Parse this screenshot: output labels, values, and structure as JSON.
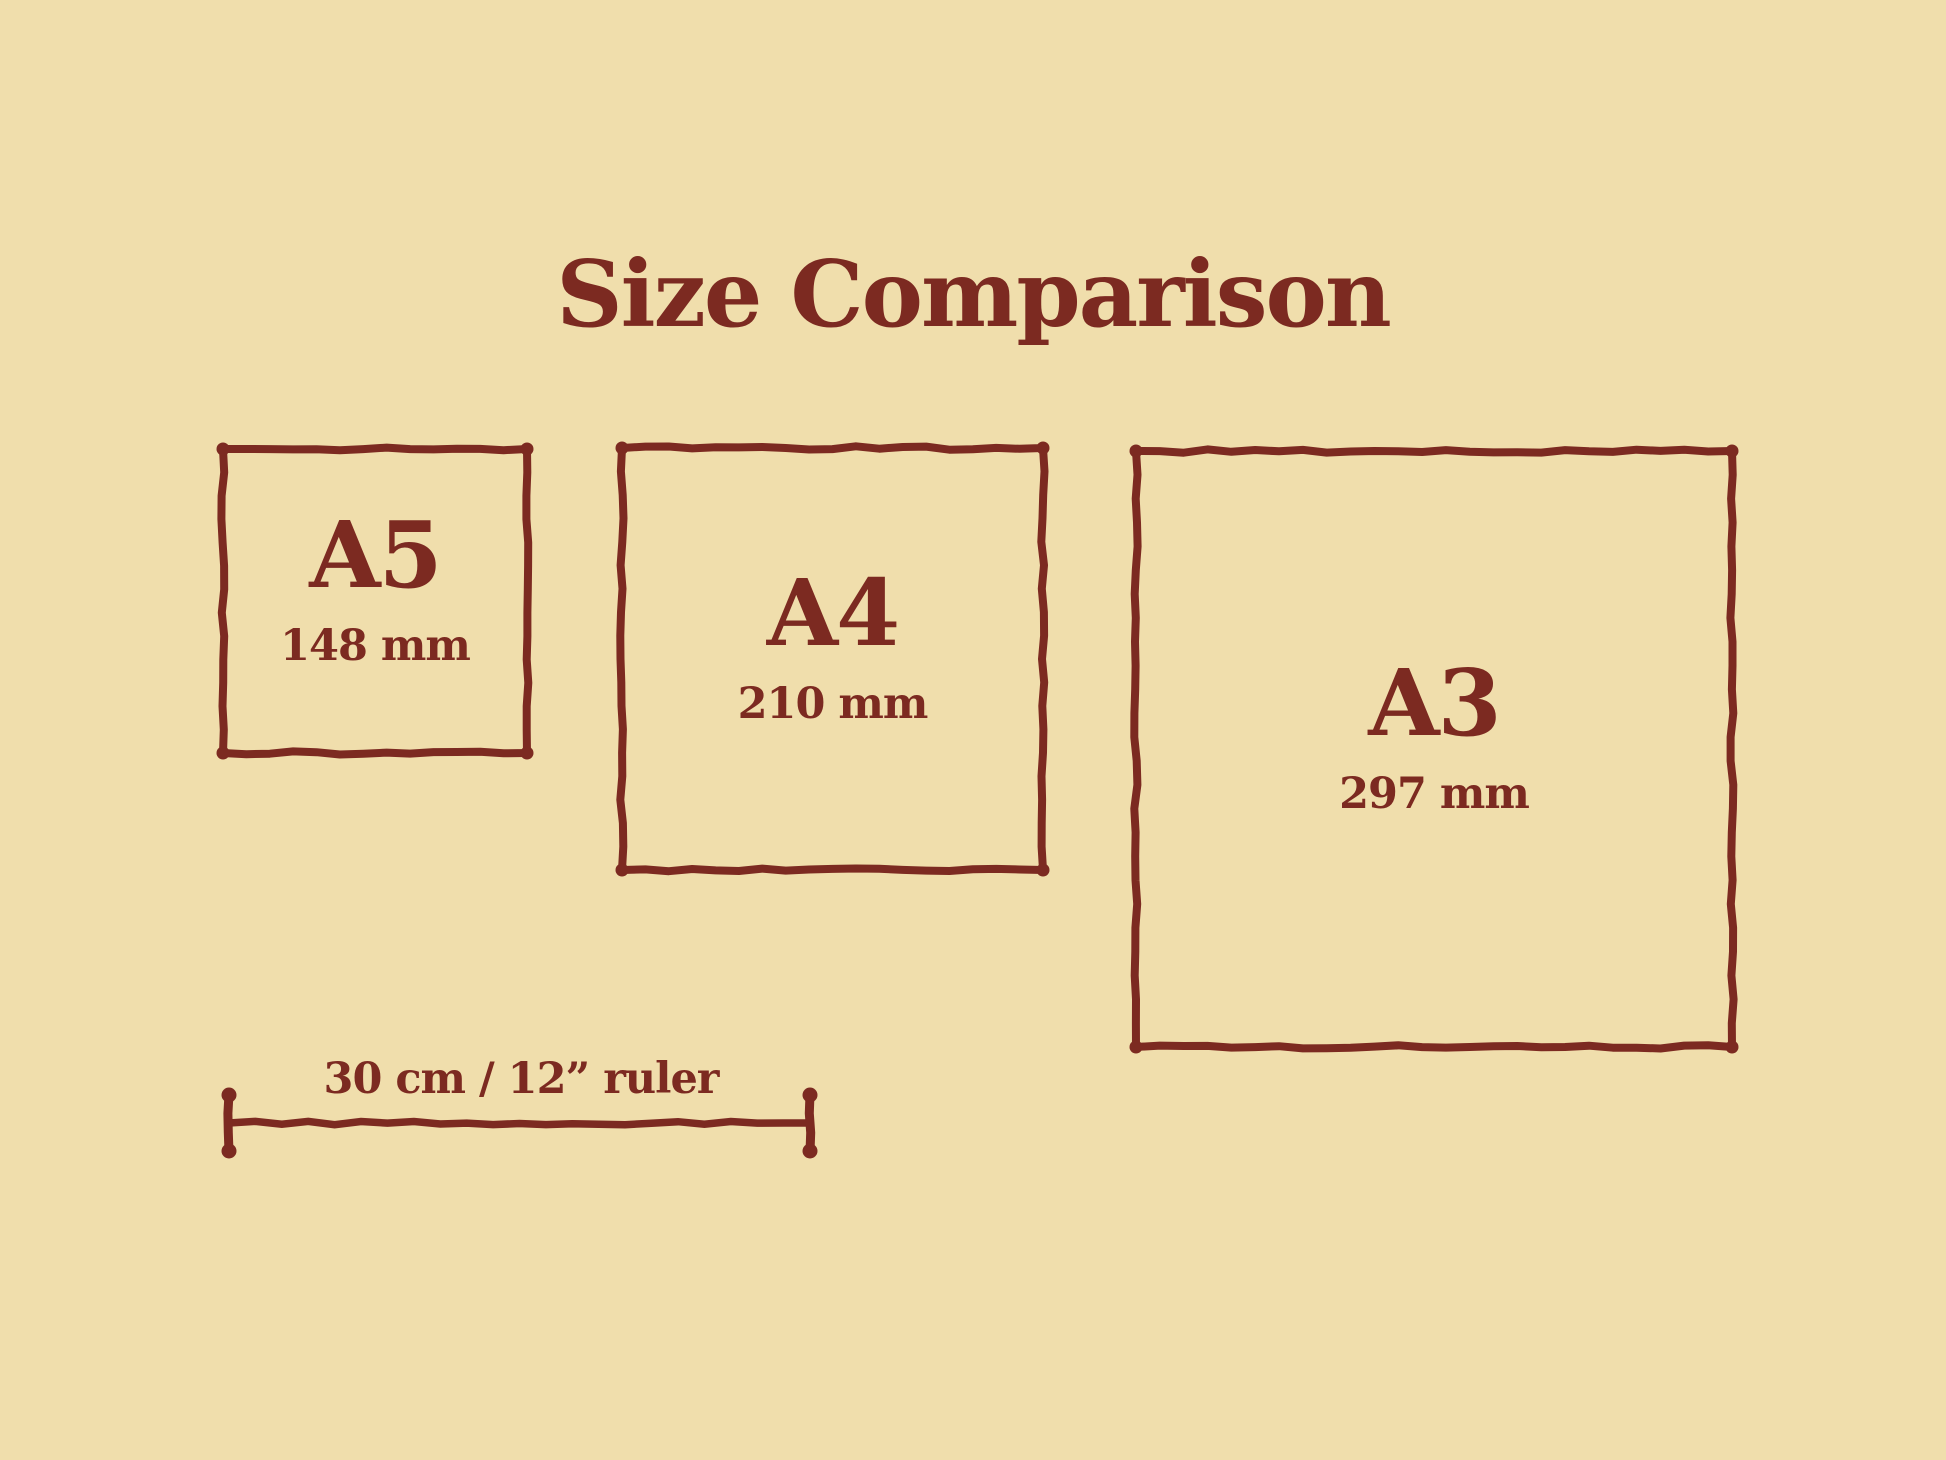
{
  "title": "Size Comparison",
  "papers": [
    {
      "id": "a5",
      "label": "A5",
      "size": "148 mm"
    },
    {
      "id": "a4",
      "label": "A4",
      "size": "210 mm"
    },
    {
      "id": "a3",
      "label": "A3",
      "size": "297 mm"
    }
  ],
  "ruler": {
    "label": "30 cm / 12” ruler"
  },
  "theme": {
    "background": "#f0deac",
    "ink": "#7c2a21"
  }
}
